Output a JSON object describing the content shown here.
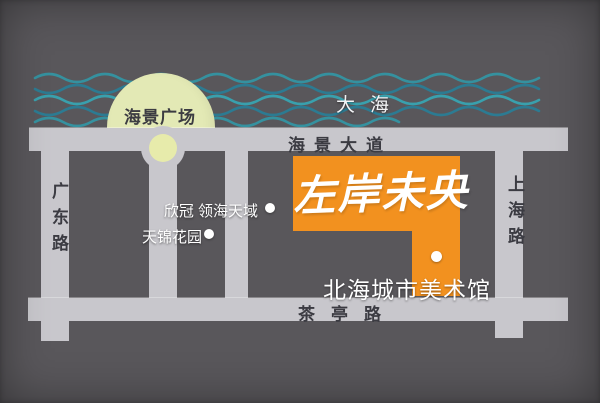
{
  "colors": {
    "background": "#59575b",
    "road": "#c8c7cc",
    "road_text": "#3b3b42",
    "property_block_orange": "#f2911f",
    "plaza_circle": "#e3e9b5",
    "roundabout_inner": "#e7ebab",
    "wave_teal": "#35919f",
    "wave_teal_dark": "#2c7b92",
    "label_white": "#ffffff"
  },
  "sea": {
    "label": "大海"
  },
  "plaza": {
    "label": "海景广场"
  },
  "roads": [
    {
      "id": "haijing-avenue",
      "label": "海景大道",
      "orientation": "horizontal"
    },
    {
      "id": "chating-road",
      "label": "茶亭路",
      "orientation": "horizontal"
    },
    {
      "id": "guangdong-road",
      "label": "广东路",
      "orientation": "vertical"
    },
    {
      "id": "shanghai-road",
      "label": "上海路",
      "orientation": "vertical"
    }
  ],
  "property": {
    "name": "左岸未央"
  },
  "pois": [
    {
      "label": "欣冠 领海天域",
      "marker": "white-dot"
    },
    {
      "label": "天锦花园",
      "marker": "white-dot"
    },
    {
      "label": "北海城市美术馆",
      "marker": "white-dot"
    }
  ]
}
